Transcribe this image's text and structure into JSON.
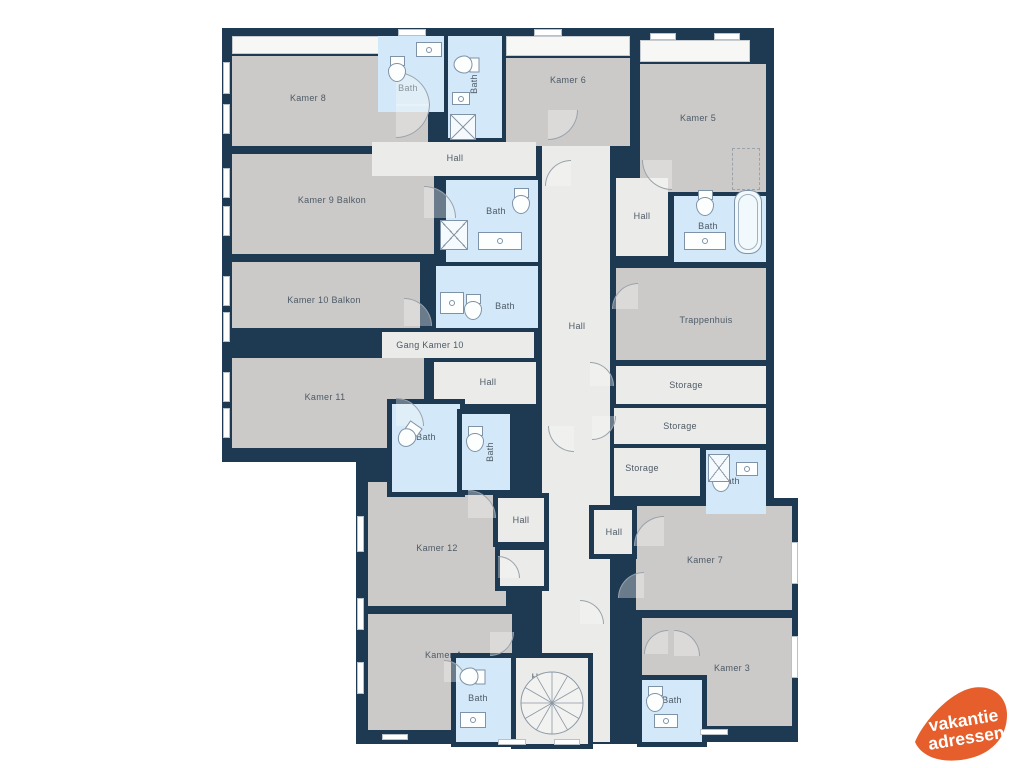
{
  "palette": {
    "wall": "#1e3a52",
    "room": "#cbcac8",
    "hall": "#ebebe9",
    "bath": "#d3e8f8",
    "balcony": "#f7f7f5",
    "label": "#4d5a66",
    "fixture": "#7e93a8",
    "door": "#9aa3ab",
    "background": "#ffffff"
  },
  "plan": {
    "backdrops": [
      {
        "x": 222,
        "y": 28,
        "w": 326,
        "h": 434
      },
      {
        "x": 530,
        "y": 28,
        "w": 244,
        "h": 480
      },
      {
        "x": 356,
        "y": 396,
        "w": 302,
        "h": 348
      },
      {
        "x": 606,
        "y": 498,
        "w": 192,
        "h": 244
      },
      {
        "x": 750,
        "y": 126,
        "w": 18,
        "h": 22
      },
      {
        "x": 366,
        "y": 426,
        "w": 28,
        "h": 56
      },
      {
        "x": 424,
        "y": 232,
        "w": 22,
        "h": 26
      }
    ],
    "balconies": [
      {
        "id": "balkon-kamer-8",
        "x": 232,
        "y": 36,
        "w": 196,
        "h": 18
      },
      {
        "id": "balkon-kamer-6",
        "x": 506,
        "y": 36,
        "w": 124,
        "h": 20
      },
      {
        "id": "balkon-kamer-5",
        "x": 640,
        "y": 40,
        "w": 110,
        "h": 22
      }
    ],
    "rooms": [
      {
        "id": "kamer-8",
        "type": "room",
        "label": "Kamer 8",
        "x": 232,
        "y": 56,
        "w": 196,
        "h": 90,
        "lx": 308,
        "ly": 98
      },
      {
        "id": "kamer-9",
        "type": "room",
        "label": "Kamer 9 Balkon",
        "x": 232,
        "y": 154,
        "w": 202,
        "h": 100,
        "lx": 332,
        "ly": 200
      },
      {
        "id": "kamer-10",
        "type": "room",
        "label": "Kamer 10 Balkon",
        "x": 232,
        "y": 262,
        "w": 188,
        "h": 66,
        "lx": 324,
        "ly": 300
      },
      {
        "id": "kamer-11",
        "type": "room",
        "label": "Kamer 11",
        "x": 232,
        "y": 358,
        "w": 192,
        "h": 90,
        "lx": 325,
        "ly": 397
      },
      {
        "id": "kamer-6",
        "type": "room",
        "label": "Kamer 6",
        "x": 506,
        "y": 58,
        "w": 124,
        "h": 88,
        "lx": 568,
        "ly": 80
      },
      {
        "id": "kamer-5",
        "type": "room",
        "label": "Kamer 5",
        "x": 640,
        "y": 64,
        "w": 126,
        "h": 128,
        "lx": 698,
        "ly": 118
      },
      {
        "id": "trappenhuis",
        "type": "room",
        "label": "Trappenhuis",
        "x": 616,
        "y": 268,
        "w": 150,
        "h": 92,
        "lx": 706,
        "ly": 320
      },
      {
        "id": "kamer-12",
        "type": "room",
        "label": "Kamer 12",
        "x": 368,
        "y": 482,
        "w": 138,
        "h": 124,
        "lx": 437,
        "ly": 548
      },
      {
        "id": "kamer-7",
        "type": "room",
        "label": "Kamer 7",
        "x": 636,
        "y": 506,
        "w": 156,
        "h": 104,
        "lx": 705,
        "ly": 560
      },
      {
        "id": "kamer-4",
        "type": "room",
        "label": "Kamer 4",
        "x": 368,
        "y": 614,
        "w": 144,
        "h": 116,
        "lx": 443,
        "ly": 655
      },
      {
        "id": "kamer-3",
        "type": "room",
        "label": "Kamer 3",
        "x": 642,
        "y": 618,
        "w": 150,
        "h": 108,
        "lx": 732,
        "ly": 668
      },
      {
        "id": "hall-top",
        "type": "hall",
        "label": "Hall",
        "x": 372,
        "y": 142,
        "w": 164,
        "h": 34,
        "lx": 455,
        "ly": 158
      },
      {
        "id": "hall-central",
        "type": "hall",
        "label": "Hall",
        "x": 542,
        "y": 146,
        "w": 68,
        "h": 596,
        "lx": 577,
        "ly": 326
      },
      {
        "id": "hall-upper-right",
        "type": "hall",
        "label": "Hall",
        "x": 616,
        "y": 178,
        "w": 52,
        "h": 78,
        "lx": 642,
        "ly": 216
      },
      {
        "id": "gang-kamer-10",
        "type": "hall",
        "label": "Gang Kamer 10",
        "x": 382,
        "y": 332,
        "w": 152,
        "h": 26,
        "lx": 430,
        "ly": 345
      },
      {
        "id": "hall-mid",
        "type": "hall",
        "label": "Hall",
        "x": 434,
        "y": 362,
        "w": 102,
        "h": 42,
        "lx": 488,
        "ly": 382
      },
      {
        "id": "storage-1",
        "type": "hall",
        "label": "Storage",
        "x": 616,
        "y": 366,
        "w": 150,
        "h": 38,
        "lx": 686,
        "ly": 385
      },
      {
        "id": "storage-2",
        "type": "hall",
        "label": "Storage",
        "x": 614,
        "y": 408,
        "w": 152,
        "h": 36,
        "lx": 680,
        "ly": 426
      },
      {
        "id": "storage-3",
        "type": "hall",
        "label": "Storage",
        "x": 614,
        "y": 448,
        "w": 86,
        "h": 48,
        "lx": 642,
        "ly": 468
      },
      {
        "id": "bath-kamer-8",
        "type": "bath",
        "label": "Bath",
        "x": 378,
        "y": 36,
        "w": 66,
        "h": 76,
        "lx": 408,
        "ly": 88
      },
      {
        "id": "bath-kamer-6",
        "type": "bath",
        "label": "Bath",
        "x": 448,
        "y": 36,
        "w": 54,
        "h": 102,
        "vertical": true,
        "lx": 474,
        "ly": 84
      },
      {
        "id": "bath-kamer-9",
        "type": "bath",
        "label": "Bath",
        "x": 446,
        "y": 180,
        "w": 92,
        "h": 82,
        "lx": 496,
        "ly": 211
      },
      {
        "id": "bath-kamer-5",
        "type": "bath",
        "label": "Bath",
        "x": 674,
        "y": 196,
        "w": 92,
        "h": 66,
        "lx": 708,
        "ly": 226
      },
      {
        "id": "bath-kamer-10",
        "type": "bath",
        "label": "Bath",
        "x": 436,
        "y": 266,
        "w": 102,
        "h": 62,
        "lx": 505,
        "ly": 306
      },
      {
        "id": "bath-storage",
        "type": "bath",
        "label": "Bath",
        "x": 706,
        "y": 450,
        "w": 60,
        "h": 64,
        "lx": 730,
        "ly": 481
      },
      {
        "id": "hall-kamer-12",
        "type": "hall",
        "label": "Hall",
        "x": 498,
        "y": 498,
        "w": 46,
        "h": 44,
        "ring": true,
        "lx": 521,
        "ly": 520
      },
      {
        "id": "hall-kamer-12b",
        "type": "hall",
        "x": 500,
        "y": 550,
        "w": 44,
        "h": 36,
        "ring": true
      },
      {
        "id": "hall-kamer-7",
        "type": "hall",
        "label": "Hall",
        "x": 594,
        "y": 510,
        "w": 38,
        "h": 44,
        "ring": true,
        "lx": 614,
        "ly": 532
      },
      {
        "id": "bath-kamer-11",
        "type": "bath",
        "label": "Bath",
        "x": 392,
        "y": 404,
        "w": 68,
        "h": 88,
        "ring": true,
        "lx": 426,
        "ly": 437
      },
      {
        "id": "bath-kamer-12",
        "type": "bath",
        "label": "Bath",
        "x": 462,
        "y": 414,
        "w": 48,
        "h": 76,
        "ring": true,
        "vertical": true,
        "lx": 490,
        "ly": 452
      },
      {
        "id": "bath-kamer-4",
        "type": "bath",
        "label": "Bath",
        "x": 456,
        "y": 658,
        "w": 60,
        "h": 84,
        "ring": true,
        "lx": 478,
        "ly": 698
      },
      {
        "id": "hall-stairs",
        "type": "hall",
        "label": "Hall",
        "x": 516,
        "y": 658,
        "w": 72,
        "h": 86,
        "ring": true,
        "lx": 540,
        "ly": 677
      },
      {
        "id": "bath-kamer-3",
        "type": "bath",
        "label": "Bath",
        "x": 642,
        "y": 680,
        "w": 60,
        "h": 62,
        "ring": true,
        "lx": 672,
        "ly": 700
      }
    ],
    "windows": [
      [
        223,
        62,
        7,
        32
      ],
      [
        223,
        104,
        7,
        30
      ],
      [
        223,
        168,
        7,
        30
      ],
      [
        223,
        206,
        7,
        30
      ],
      [
        223,
        276,
        7,
        30
      ],
      [
        223,
        312,
        7,
        30
      ],
      [
        223,
        372,
        7,
        30
      ],
      [
        223,
        408,
        7,
        30
      ],
      [
        398,
        29,
        28,
        7
      ],
      [
        534,
        29,
        28,
        7
      ],
      [
        650,
        33,
        26,
        7
      ],
      [
        714,
        33,
        26,
        7
      ],
      [
        791,
        542,
        7,
        42
      ],
      [
        791,
        636,
        7,
        42
      ],
      [
        357,
        516,
        7,
        36
      ],
      [
        357,
        598,
        7,
        32
      ],
      [
        357,
        662,
        7,
        32
      ],
      [
        498,
        739,
        28,
        6
      ],
      [
        554,
        739,
        26,
        6
      ],
      [
        382,
        734,
        26,
        6
      ],
      [
        700,
        729,
        28,
        6
      ]
    ],
    "doors": [
      {
        "x": 396,
        "y": 72,
        "r": 34,
        "c": "ne"
      },
      {
        "x": 396,
        "y": 104,
        "r": 34,
        "c": "se"
      },
      {
        "x": 424,
        "y": 186,
        "r": 32,
        "c": "ne"
      },
      {
        "x": 404,
        "y": 298,
        "r": 28,
        "c": "ne"
      },
      {
        "x": 396,
        "y": 398,
        "r": 28,
        "c": "ne"
      },
      {
        "x": 548,
        "y": 110,
        "r": 30,
        "c": "se"
      },
      {
        "x": 642,
        "y": 160,
        "r": 30,
        "c": "sw"
      },
      {
        "x": 545,
        "y": 160,
        "r": 26,
        "c": "nw"
      },
      {
        "x": 612,
        "y": 283,
        "r": 26,
        "c": "nw"
      },
      {
        "x": 590,
        "y": 362,
        "r": 24,
        "c": "ne"
      },
      {
        "x": 592,
        "y": 416,
        "r": 24,
        "c": "se"
      },
      {
        "x": 468,
        "y": 490,
        "r": 28,
        "c": "ne"
      },
      {
        "x": 498,
        "y": 556,
        "r": 22,
        "c": "ne"
      },
      {
        "x": 634,
        "y": 516,
        "r": 30,
        "c": "nw"
      },
      {
        "x": 618,
        "y": 572,
        "r": 26,
        "c": "nw"
      },
      {
        "x": 490,
        "y": 632,
        "r": 24,
        "c": "se"
      },
      {
        "x": 444,
        "y": 660,
        "r": 22,
        "c": "ne"
      },
      {
        "x": 644,
        "y": 630,
        "r": 24,
        "c": "nw"
      },
      {
        "x": 674,
        "y": 630,
        "r": 26,
        "c": "ne"
      },
      {
        "x": 548,
        "y": 426,
        "r": 26,
        "c": "sw"
      },
      {
        "x": 580,
        "y": 600,
        "r": 24,
        "c": "ne"
      }
    ],
    "fixtures": [
      {
        "t": "toilet",
        "x": 388,
        "y": 56,
        "rot": 0
      },
      {
        "t": "toilet",
        "x": 458,
        "y": 52,
        "rot": 90
      },
      {
        "t": "toilet",
        "x": 512,
        "y": 188,
        "rot": 0
      },
      {
        "t": "toilet",
        "x": 696,
        "y": 190,
        "rot": 0
      },
      {
        "t": "toilet",
        "x": 464,
        "y": 294,
        "rot": 0
      },
      {
        "t": "toilet",
        "x": 712,
        "y": 466,
        "rot": 0
      },
      {
        "t": "toilet",
        "x": 400,
        "y": 422,
        "rot": 35
      },
      {
        "t": "toilet",
        "x": 466,
        "y": 426,
        "rot": 0
      },
      {
        "t": "toilet",
        "x": 464,
        "y": 664,
        "rot": 90
      },
      {
        "t": "toilet",
        "x": 646,
        "y": 686,
        "rot": 0
      },
      {
        "t": "sink",
        "x": 416,
        "y": 42,
        "w": 26,
        "h": 15
      },
      {
        "t": "sink",
        "x": 452,
        "y": 92,
        "w": 18,
        "h": 13
      },
      {
        "t": "sink",
        "x": 478,
        "y": 232,
        "w": 44,
        "h": 18
      },
      {
        "t": "sink",
        "x": 684,
        "y": 232,
        "w": 42,
        "h": 18
      },
      {
        "t": "sink",
        "x": 440,
        "y": 292,
        "w": 24,
        "h": 22
      },
      {
        "t": "sink",
        "x": 736,
        "y": 462,
        "w": 22,
        "h": 14
      },
      {
        "t": "sink",
        "x": 460,
        "y": 712,
        "w": 26,
        "h": 16
      },
      {
        "t": "sink",
        "x": 654,
        "y": 714,
        "w": 24,
        "h": 14
      },
      {
        "t": "tub",
        "x": 734,
        "y": 190,
        "w": 28,
        "h": 64
      },
      {
        "t": "shower",
        "x": 450,
        "y": 114,
        "w": 26,
        "h": 26
      },
      {
        "t": "shower",
        "x": 440,
        "y": 220,
        "w": 28,
        "h": 30
      },
      {
        "t": "shower",
        "x": 708,
        "y": 454,
        "w": 22,
        "h": 28
      },
      {
        "t": "dashed",
        "x": 732,
        "y": 148,
        "w": 28,
        "h": 42
      }
    ],
    "spiral_stair": {
      "cx": 552,
      "cy": 703,
      "r": 31
    }
  },
  "logo": {
    "line1": "vakantie",
    "line2": "adressen",
    "color": "#e55e2b",
    "text_color": "#ffffff"
  }
}
